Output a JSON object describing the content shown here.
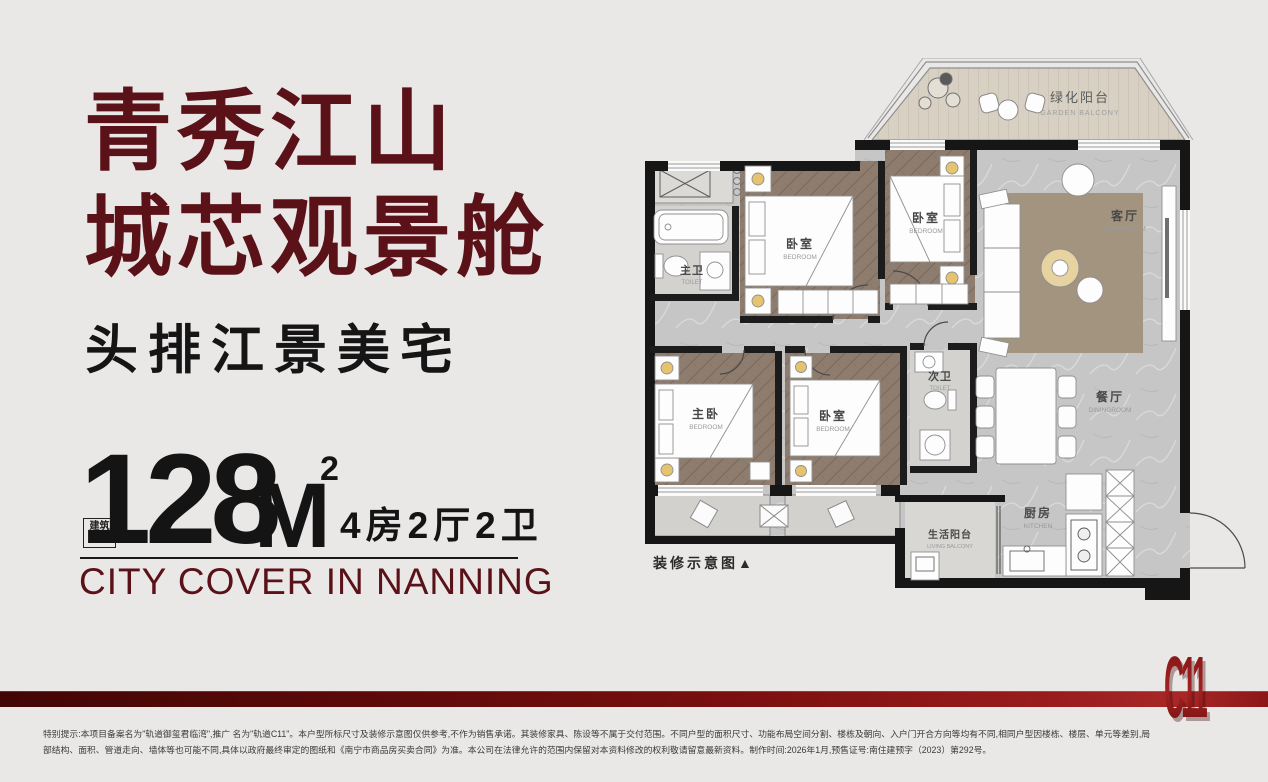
{
  "hero": {
    "title_line1": "青秀江山",
    "title_line2": "城芯观景舱",
    "subtitle": "头排江景美宅"
  },
  "area": {
    "label_box_line1": "建筑",
    "label_box_line2": "面积",
    "label_box_sup": "约",
    "value": "128",
    "unit": "M",
    "unit_sup": "2",
    "layout": "4房2厅2卫",
    "tagline_en": "CITY COVER IN NANNING"
  },
  "floorplan": {
    "caption": "装修示意图▲",
    "rooms": [
      {
        "cn": "绿化阳台",
        "en": "GARDEN BALCONY"
      },
      {
        "cn": "卧室",
        "en": "BEDROOM"
      },
      {
        "cn": "卧室",
        "en": "BEDROOM"
      },
      {
        "cn": "客厅",
        "en": "LIVINGROOM"
      },
      {
        "cn": "主卫",
        "en": "TOILET"
      },
      {
        "cn": "主卧",
        "en": "BEDROOM"
      },
      {
        "cn": "卧室",
        "en": "BEDROOM"
      },
      {
        "cn": "次卫",
        "en": "TOILET"
      },
      {
        "cn": "餐厅",
        "en": "DININGROOM"
      },
      {
        "cn": "厨房",
        "en": "KITCHEN"
      },
      {
        "cn": "生活阳台",
        "en": "LIVING BALCONY"
      }
    ]
  },
  "footer": {
    "logo": "C11",
    "disclaimer_line1": "特别提示:本项目备案名为\"轨道御玺君临湾\",推广 名为\"轨道C11\"。本户型所标尺寸及装修示意图仅供参考,不作为销售承诺。其装修家具、陈设等不属于交付范围。不同户型的面积尺寸、功能布局空间分割、楼栋及朝向、入户门开合方向等均有不同,相同户型因楼栋、楼层、单元等差别,局",
    "disclaimer_line2": "部结构、面积、管道走向、墙体等也可能不同,具体以政府最终审定的图纸和《南宁市商品房买卖合同》为准。本公司在法律允许的范围内保留对本资料修改的权利敬请留意最新资料。制作时间:2026年1月,预售证号:南住建预字（2023）第292号。"
  },
  "colors": {
    "background": "#eae8e7",
    "brand_maroon": "#5a1118",
    "bar_dark": "#420606",
    "bar_bright": "#a82828",
    "logo_red": "#8f1a1a"
  }
}
